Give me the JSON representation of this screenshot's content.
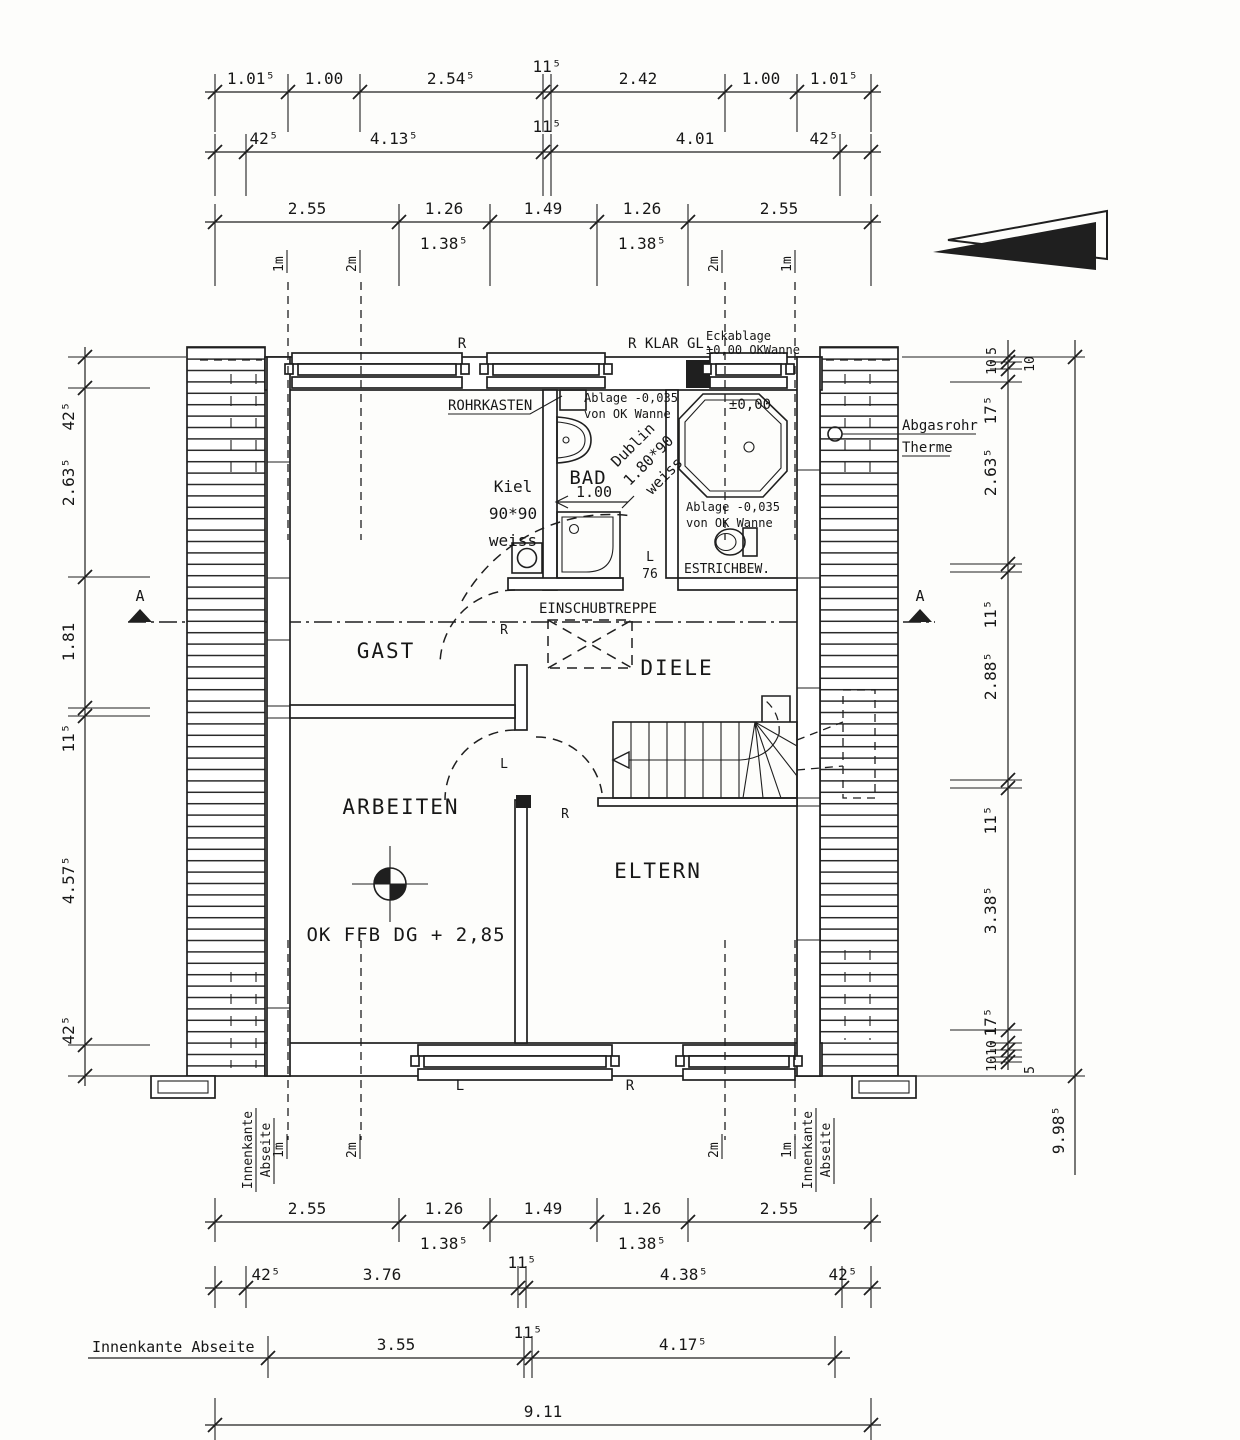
{
  "colors": {
    "paper": "#fdfdfb",
    "ink": "#1f1f1f"
  },
  "rooms": {
    "gast": "GAST",
    "arbeiten": "ARBEITEN",
    "diele": "DIELE",
    "eltern": "ELTERN",
    "bad": "BAD"
  },
  "labels": {
    "rohrkasten": "ROHRKASTEN",
    "klar_gl": "R KLAR GL.",
    "eckablage1": "Eckablage",
    "eckablage2": "±0,00 OKWanne",
    "ablage_top1": "Ablage -0,035",
    "ablage_top2": "von OK Wanne",
    "ablage_wc1": "Ablage -0,035",
    "ablage_wc2": "von OK Wanne",
    "pm000": "±0,00",
    "kiel1": "Kiel",
    "kiel2": "90*90",
    "kiel3": "weiss",
    "dublin1": "Dublin",
    "dublin2": "1.80*90",
    "dublin3": "weiss",
    "estrichbew": "ESTRICHBEW.",
    "einschubtreppe": "EINSCHUBTREPPE",
    "bad_door": "1.00",
    "wc_door_l": "L",
    "wc_door_76": "76",
    "ok_ffb": "OK FFB DG + 2,85",
    "abgasrohr": "Abgasrohr",
    "therme": "Therme",
    "innenkante": "Innenkante",
    "abseite": "Abseite",
    "innenkante_abseite": "Innenkante Abseite",
    "section_a": "A",
    "m1": "1m",
    "m2": "2m",
    "win_r": "R",
    "win_l": "L",
    "door_r": "R",
    "door_l": "L"
  },
  "dims": {
    "top1": [
      "1.01⁵",
      "1.00",
      "2.54⁵",
      "11⁵",
      "2.42",
      "1.00",
      "1.01⁵"
    ],
    "top2": [
      "42⁵",
      "4.13⁵",
      "11⁵",
      "4.01",
      "42⁵"
    ],
    "top3": [
      "2.55",
      "1.26",
      "1.38⁵",
      "1.49",
      "1.26",
      "1.38⁵",
      "2.55"
    ],
    "left": [
      "42⁵",
      "2.63⁵",
      "1.81",
      "11⁵",
      "4.57⁵",
      "42⁵"
    ],
    "right": [
      "5",
      "10",
      "10",
      "17⁵",
      "2.63⁵",
      "11⁵",
      "2.88⁵",
      "11⁵",
      "3.38⁵",
      "17⁵",
      "10",
      "10",
      "5"
    ],
    "right_total": "9.98⁵",
    "bottom1": [
      "2.55",
      "1.26",
      "1.38⁵",
      "1.49",
      "1.26",
      "1.38⁵",
      "2.55"
    ],
    "bottom2": [
      "42⁵",
      "3.76",
      "11⁵",
      "4.38⁵",
      "42⁵"
    ],
    "bottom3": [
      "3.55",
      "11⁵",
      "4.17⁵"
    ],
    "bottom_total": "9.11"
  }
}
